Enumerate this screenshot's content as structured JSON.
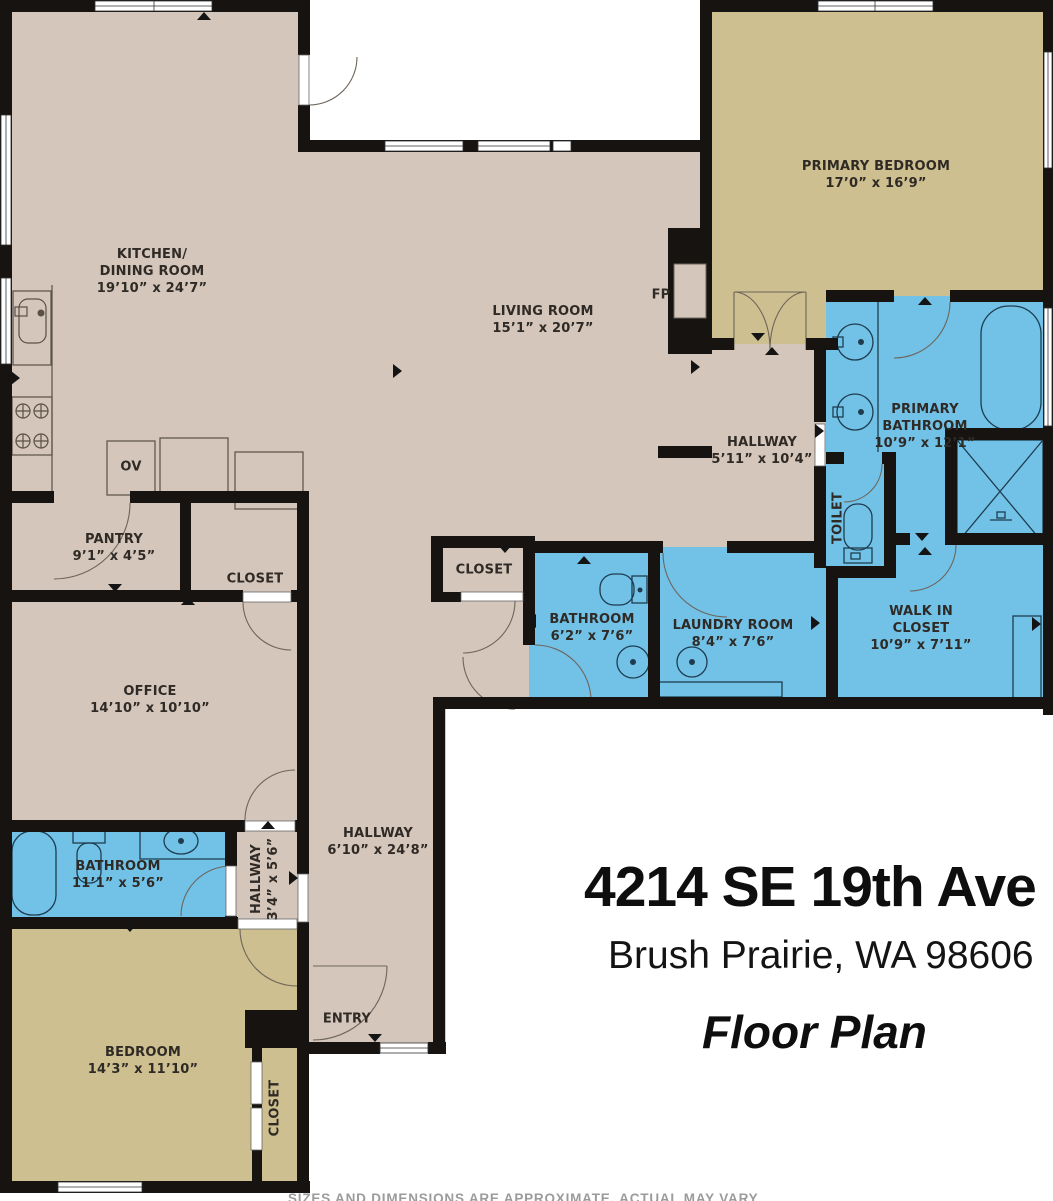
{
  "title": {
    "address": "4214 SE 19th Ave",
    "city_state_zip": "Brush Prairie, WA 98606",
    "caption": "Floor Plan"
  },
  "disclaimer": "SIZES AND DIMENSIONS ARE APPROXIMATE, ACTUAL MAY VARY",
  "colors": {
    "floor": "#d4c6ba",
    "bedroom_floor": "#cdbf90",
    "bath_floor": "#72c2e8",
    "wall": "#161311",
    "label_text": "#2f2a25",
    "background": "#ffffff"
  },
  "rooms": {
    "kitchen": {
      "name": "KITCHEN/\nDINING ROOM",
      "dims": "19’10” x 24’7”"
    },
    "living": {
      "name": "LIVING ROOM",
      "dims": "15’1” x 20’7”"
    },
    "primary_bedroom": {
      "name": "PRIMARY BEDROOM",
      "dims": "17’0” x 16’9”"
    },
    "primary_bathroom": {
      "name": "PRIMARY\nBATHROOM",
      "dims": "10’9” x 12’1”"
    },
    "hallway_upper": {
      "name": "HALLWAY",
      "dims": "5’11” x 10’4”"
    },
    "toilet": {
      "name": "TOILET"
    },
    "pantry": {
      "name": "PANTRY",
      "dims": "9’1” x 4’5”"
    },
    "closet_pantry": {
      "name": "CLOSET"
    },
    "office": {
      "name": "OFFICE",
      "dims": "14’10” x 10’10”"
    },
    "closet_hall": {
      "name": "CLOSET"
    },
    "bathroom_center": {
      "name": "BATHROOM",
      "dims": "6’2” x 7’6”"
    },
    "laundry": {
      "name": "LAUNDRY ROOM",
      "dims": "8’4” x 7’6”"
    },
    "walkin_closet": {
      "name": "WALK IN\nCLOSET",
      "dims": "10’9” x 7’11”"
    },
    "hallway_lower": {
      "name": "HALLWAY",
      "dims": "6’10” x 24’8”"
    },
    "bathroom_lower": {
      "name": "BATHROOM",
      "dims": "11’1” x 5’6”"
    },
    "hallway_small": {
      "name": "HALLWAY",
      "dims": "3’4” x 5’6”"
    },
    "bedroom": {
      "name": "BEDROOM",
      "dims": "14’3” x 11’10”"
    },
    "closet_bedroom": {
      "name": "CLOSET"
    },
    "entry": {
      "name": "ENTRY"
    },
    "fireplace": {
      "name": "FP"
    },
    "oven": {
      "name": "OV"
    }
  }
}
